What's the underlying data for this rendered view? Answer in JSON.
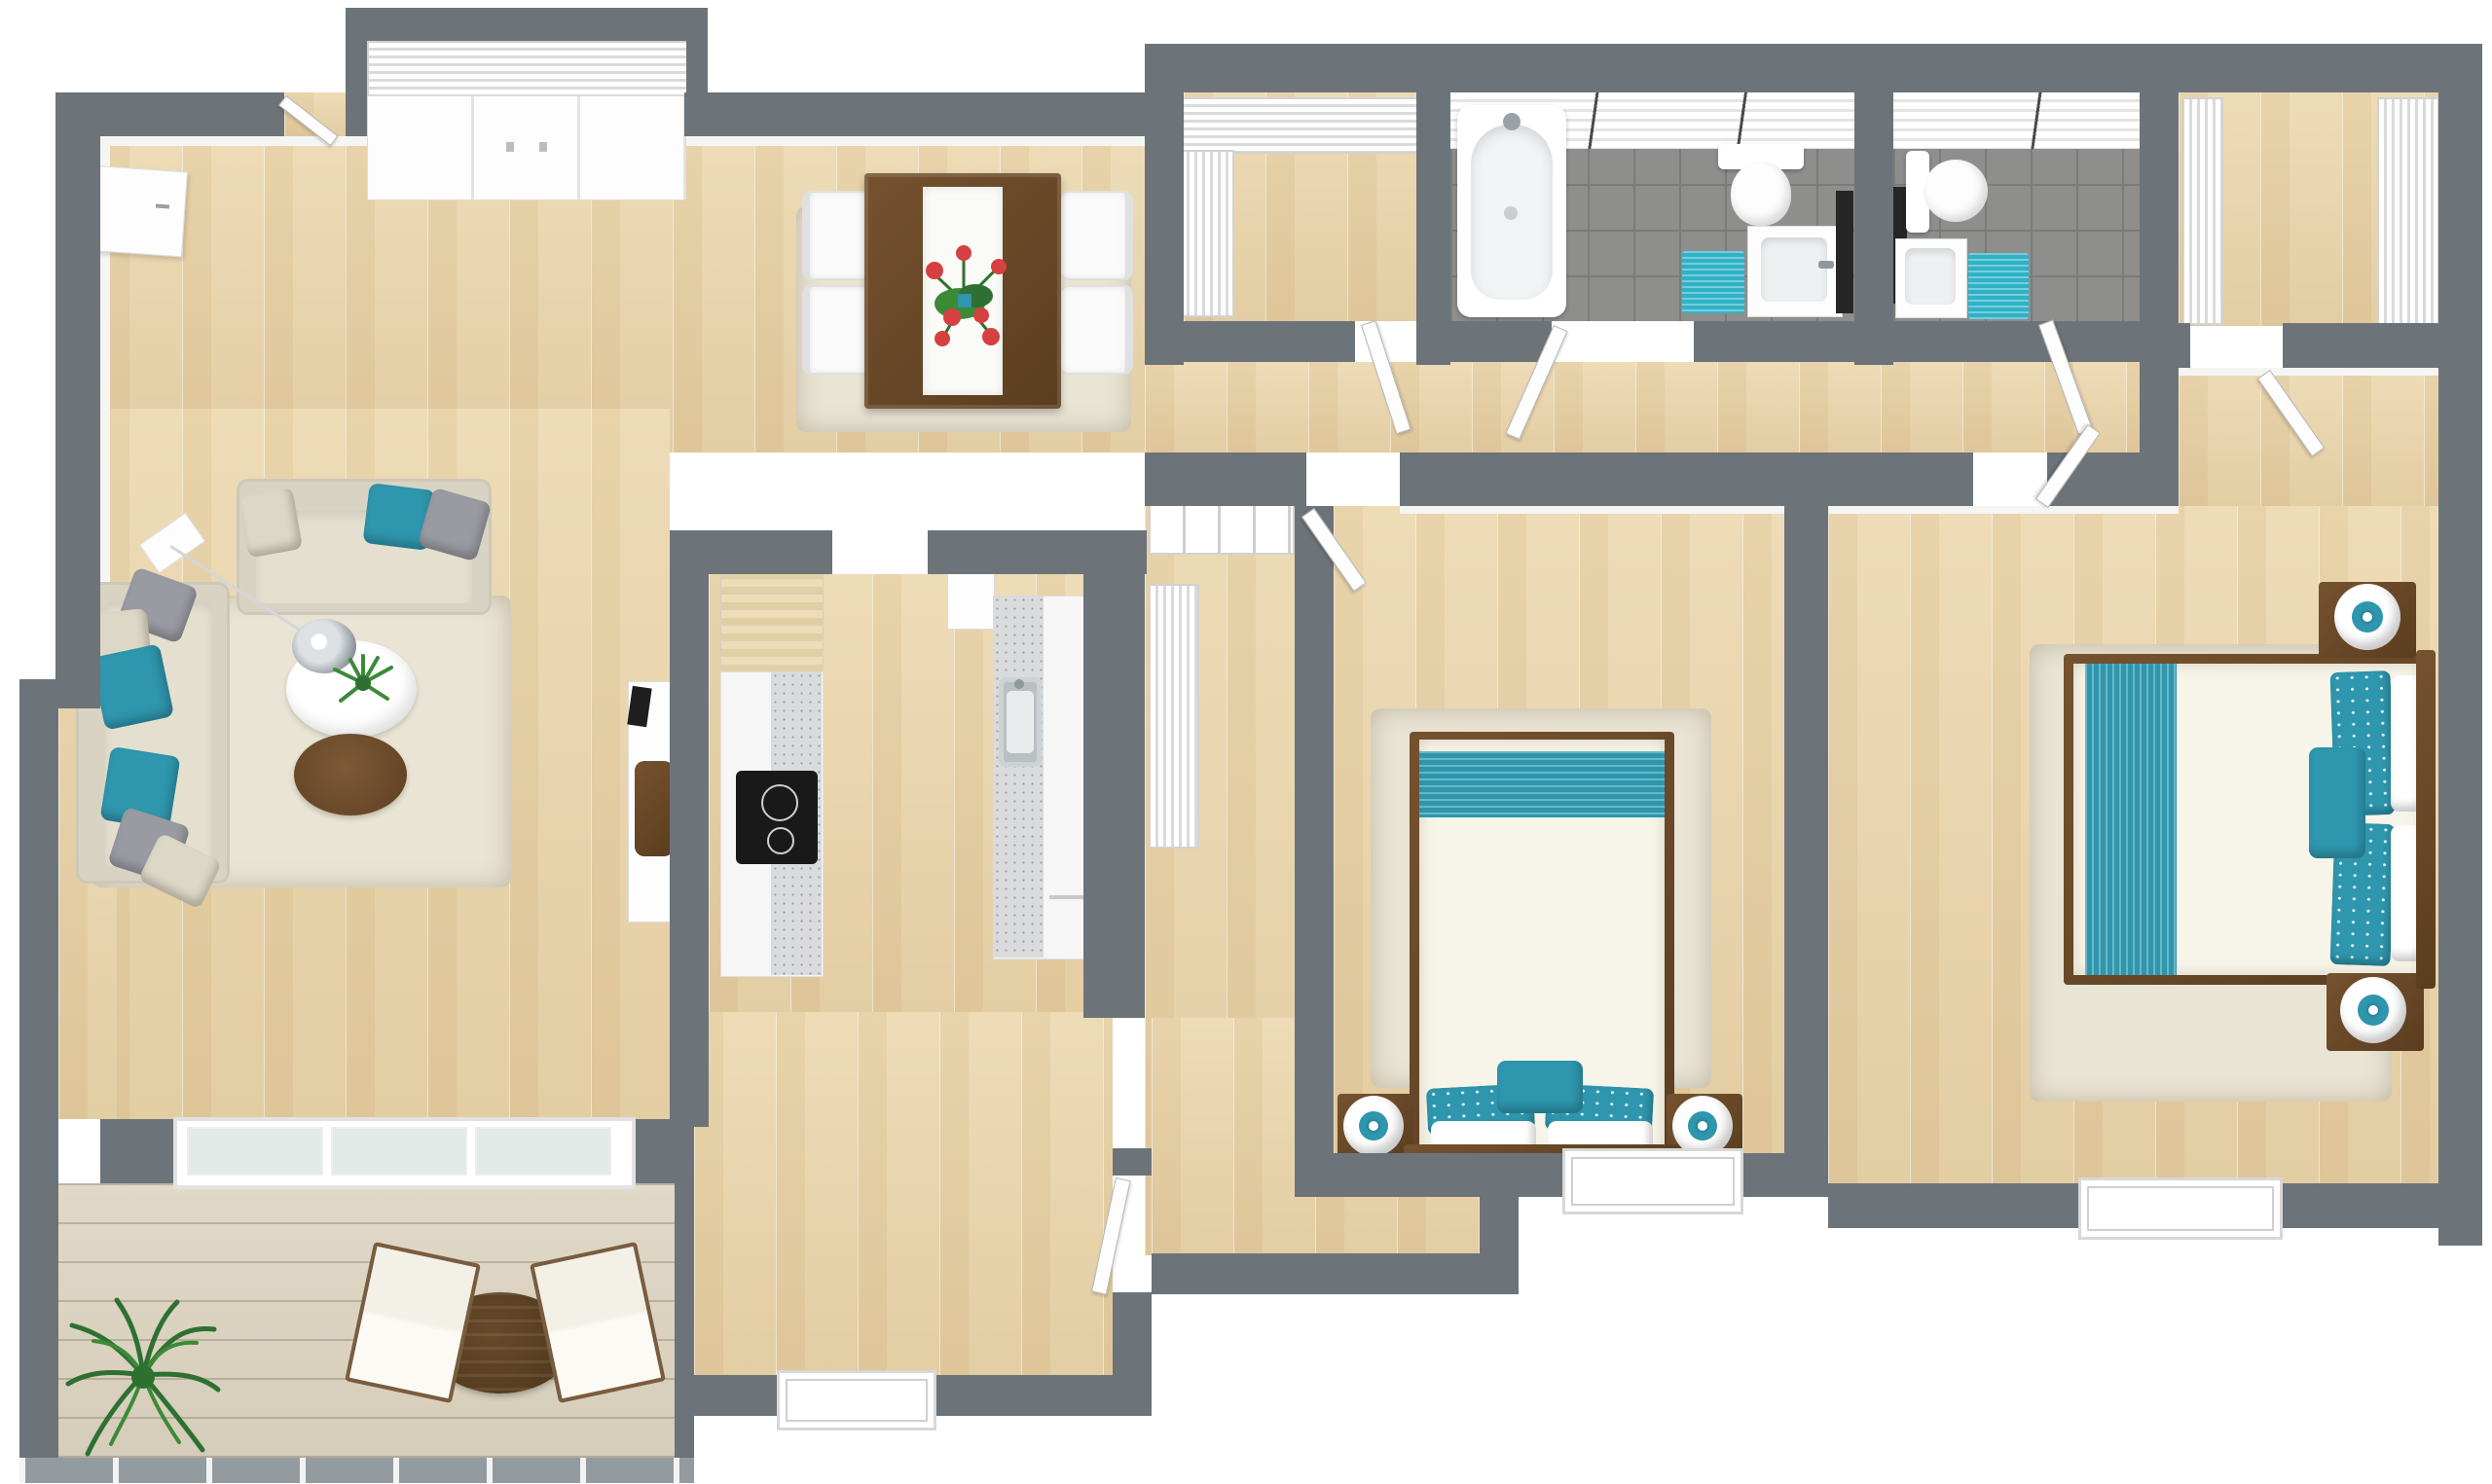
{
  "meta": {
    "title": "3D rendered floor plan — two-bedroom apartment, top-down view",
    "style": "photoreal 3D render, no text labels visible",
    "walls_color_note": "slate gray walls, ash wood floors, teal accent fabrics"
  },
  "palette": {
    "wall": "#6d7479",
    "wallLight": "#949ba0",
    "wood1": "#eedcb7",
    "wood2": "#e3cda3",
    "tile": "#8e8e8c",
    "grout": "#7b7b79",
    "teal": "#2e96ad",
    "tealBright": "#2fb2c6",
    "sofa": "#d8d3c2",
    "grayPillow": "#9a9aa2",
    "rug": "#eae4d4",
    "woodDark": "#6a4b2e",
    "chrome": "#aab0b5",
    "plantGreen": "#3c8a38",
    "flowerRed": "#d64040"
  },
  "rooms": {
    "entry": {
      "name": "Entry foyer",
      "items": [
        "front door (open)",
        "louvered sliding-door closet",
        "white console cabinet"
      ]
    },
    "living": {
      "name": "Living room",
      "items": [
        "3-seat sofa",
        "2-seat sofa",
        "teal and gray throw pillows",
        "arc floor lamp with chrome dome",
        "round white side table with plant",
        "round wood coffee table",
        "shag area rug",
        "white media console with chair"
      ]
    },
    "dining": {
      "name": "Dining area",
      "items": [
        "dark wood dining table",
        "white table runner",
        "red flower centerpiece",
        "4 white upholstered chairs",
        "area rug"
      ]
    },
    "kitchen": {
      "name": "Kitchen",
      "items": [
        "wood-front tall cabinet",
        "white counter run with speckled top",
        "black induction cooktop",
        "second counter run",
        "stainless sink",
        "dishwasher front"
      ]
    },
    "den": {
      "name": "Den / flex room",
      "items": [
        "window",
        "door to bedroom hall"
      ]
    },
    "corridor": {
      "name": "Bedroom corridor",
      "items": [
        "bifold louvered closet",
        "tall louvered linen closet"
      ]
    },
    "storage": {
      "name": "Storage / laundry room",
      "items": [
        "L-shaped louvered closets",
        "door"
      ]
    },
    "bath1": {
      "name": "Main bathroom",
      "items": [
        "bathtub",
        "toilet",
        "vanity sink",
        "teal bath mat",
        "tall black cabinet",
        "gray tile floor",
        "white tiled walls"
      ]
    },
    "bath2": {
      "name": "Ensuite bathroom",
      "items": [
        "toilet",
        "vanity sink",
        "black mirror cabinet",
        "teal bath mat",
        "gray tile floor"
      ]
    },
    "walkin": {
      "name": "Walk-in closet",
      "items": [
        "louvered wardrobe left",
        "louvered wardrobe right",
        "door"
      ]
    },
    "bedroom1": {
      "name": "Bedroom 1",
      "items": [
        "double bed with teal striped runner",
        "teal floral pillows",
        "2 nightstands with ring lamps",
        "shag rug",
        "window"
      ]
    },
    "bedroom2": {
      "name": "Bedroom 2 (master)",
      "items": [
        "double bed with teal striped runner",
        "teal floral pillows",
        "2 dark nightstands with sphere lamps",
        "shag rug",
        "window"
      ]
    },
    "balcony": {
      "name": "Balcony",
      "items": [
        "weathered plank decking",
        "round bistro table",
        "2 white sling chairs",
        "potted palm",
        "railing",
        "sliding glass door"
      ]
    }
  }
}
